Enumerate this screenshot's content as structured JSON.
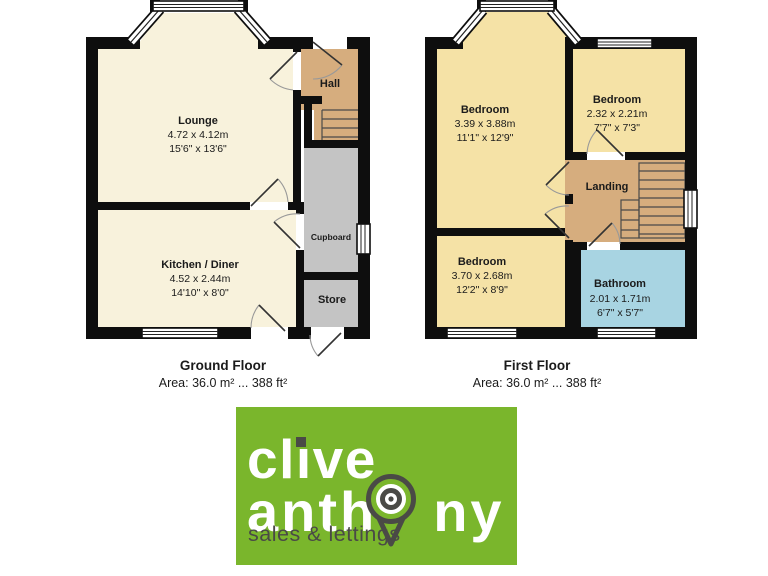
{
  "colors": {
    "wall": "#0e0e0e",
    "lounge_cream": "#f8f2dc",
    "bedroom_yellow": "#f5e2a6",
    "hall_tan": "#d6ad7e",
    "storage_gray": "#c4c4c4",
    "bathroom_blue": "#a8d4e2",
    "logo_green": "#7ab62c",
    "logo_dark": "#4a4a46"
  },
  "ground_floor": {
    "title": "Ground Floor",
    "area": "Area: 36.0 m² ... 388 ft²",
    "rooms": {
      "lounge": {
        "name": "Lounge",
        "dim_m": "4.72 x 4.12m",
        "dim_ft": "15'6\" x 13'6\""
      },
      "hall": {
        "name": "Hall"
      },
      "kitchen": {
        "name": "Kitchen / Diner",
        "dim_m": "4.52 x 2.44m",
        "dim_ft": "14'10\" x 8'0\""
      },
      "cupboard": {
        "name": "Cupboard"
      },
      "store": {
        "name": "Store"
      }
    }
  },
  "first_floor": {
    "title": "First Floor",
    "area": "Area: 36.0 m² ... 388 ft²",
    "rooms": {
      "bedroom_front": {
        "name": "Bedroom",
        "dim_m": "3.39 x 3.88m",
        "dim_ft": "11'1\" x 12'9\""
      },
      "bedroom_small": {
        "name": "Bedroom",
        "dim_m": "2.32 x 2.21m",
        "dim_ft": "7'7\" x 7'3\""
      },
      "landing": {
        "name": "Landing"
      },
      "bedroom_back": {
        "name": "Bedroom",
        "dim_m": "3.70 x 2.68m",
        "dim_ft": "12'2\" x 8'9\""
      },
      "bathroom": {
        "name": "Bathroom",
        "dim_m": "2.01 x 1.71m",
        "dim_ft": "6'7\" x 5'7\""
      }
    }
  },
  "logo": {
    "line1": "clive",
    "line1_pre": "cl",
    "line1_dotless_i": "ı",
    "line1_post": "ve",
    "line2": "anthony",
    "line2_pre": "anth",
    "line2_post": "ny",
    "tagline": "sales & lettings"
  }
}
